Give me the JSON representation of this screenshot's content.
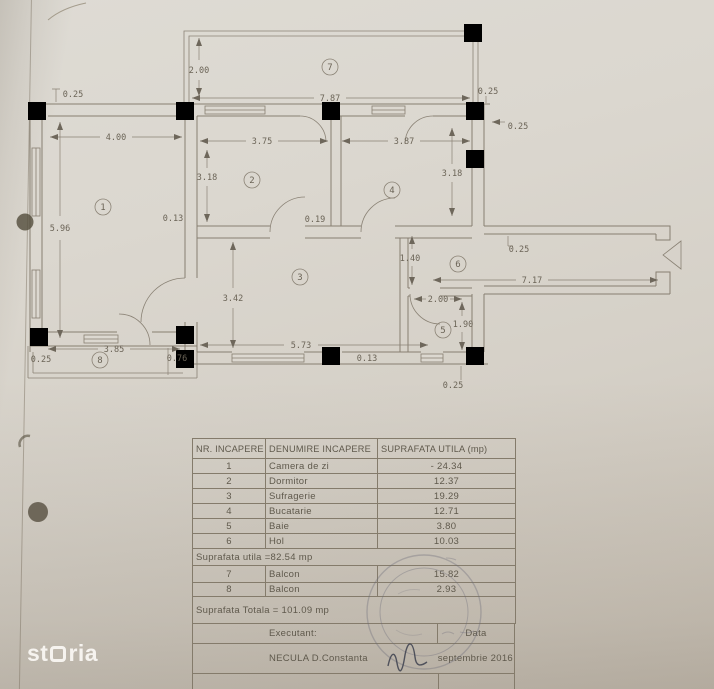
{
  "watermark": {
    "text": "storia",
    "part1": "st",
    "part2": "ria"
  },
  "plan": {
    "rooms": [
      {
        "num": "1"
      },
      {
        "num": "2"
      },
      {
        "num": "3"
      },
      {
        "num": "4"
      },
      {
        "num": "5"
      },
      {
        "num": "6"
      },
      {
        "num": "7"
      },
      {
        "num": "8"
      }
    ],
    "dims": [
      {
        "t": "0.25"
      },
      {
        "t": "4.00"
      },
      {
        "t": "2.00"
      },
      {
        "t": "7.87"
      },
      {
        "t": "0.25"
      },
      {
        "t": "3.75"
      },
      {
        "t": "3.87"
      },
      {
        "t": "0.25"
      },
      {
        "t": "3.18"
      },
      {
        "t": "3.18"
      },
      {
        "t": "5.96"
      },
      {
        "t": "0.13"
      },
      {
        "t": "0.19"
      },
      {
        "t": "1.40"
      },
      {
        "t": "0.25"
      },
      {
        "t": "7.17"
      },
      {
        "t": "3.42"
      },
      {
        "t": "2.00"
      },
      {
        "t": "1.90"
      },
      {
        "t": "5.73"
      },
      {
        "t": "0.13"
      },
      {
        "t": "3.85"
      },
      {
        "t": "0.76"
      },
      {
        "t": "0.25"
      },
      {
        "t": "0.25"
      }
    ]
  },
  "table": {
    "headers": [
      "NR. INCAPERE",
      "DENUMIRE INCAPERE",
      "SUPRAFATA UTILA (mp)"
    ],
    "rows": [
      {
        "nr": "1",
        "name": "Camera de zi",
        "area": "- 24.34"
      },
      {
        "nr": "2",
        "name": "Dormitor",
        "area": "12.37"
      },
      {
        "nr": "3",
        "name": "Sufragerie",
        "area": "19.29"
      },
      {
        "nr": "4",
        "name": "Bucatarie",
        "area": "12.71"
      },
      {
        "nr": "5",
        "name": "Baie",
        "area": "3.80"
      },
      {
        "nr": "6",
        "name": "Hol",
        "area": "10.03"
      }
    ],
    "subtotal": "Suprafata utila =82.54 mp",
    "balcony_rows": [
      {
        "nr": "7",
        "name": "Balcon",
        "area": "15.82"
      },
      {
        "nr": "8",
        "name": "Balcon",
        "area": "2.93"
      }
    ],
    "total": "Suprafata Totala = 101.09 mp",
    "executant_label": "Executant:",
    "data_label": "Data",
    "executant_name": "NECULA D.Constanta",
    "date_value": "septembrie 2016"
  }
}
